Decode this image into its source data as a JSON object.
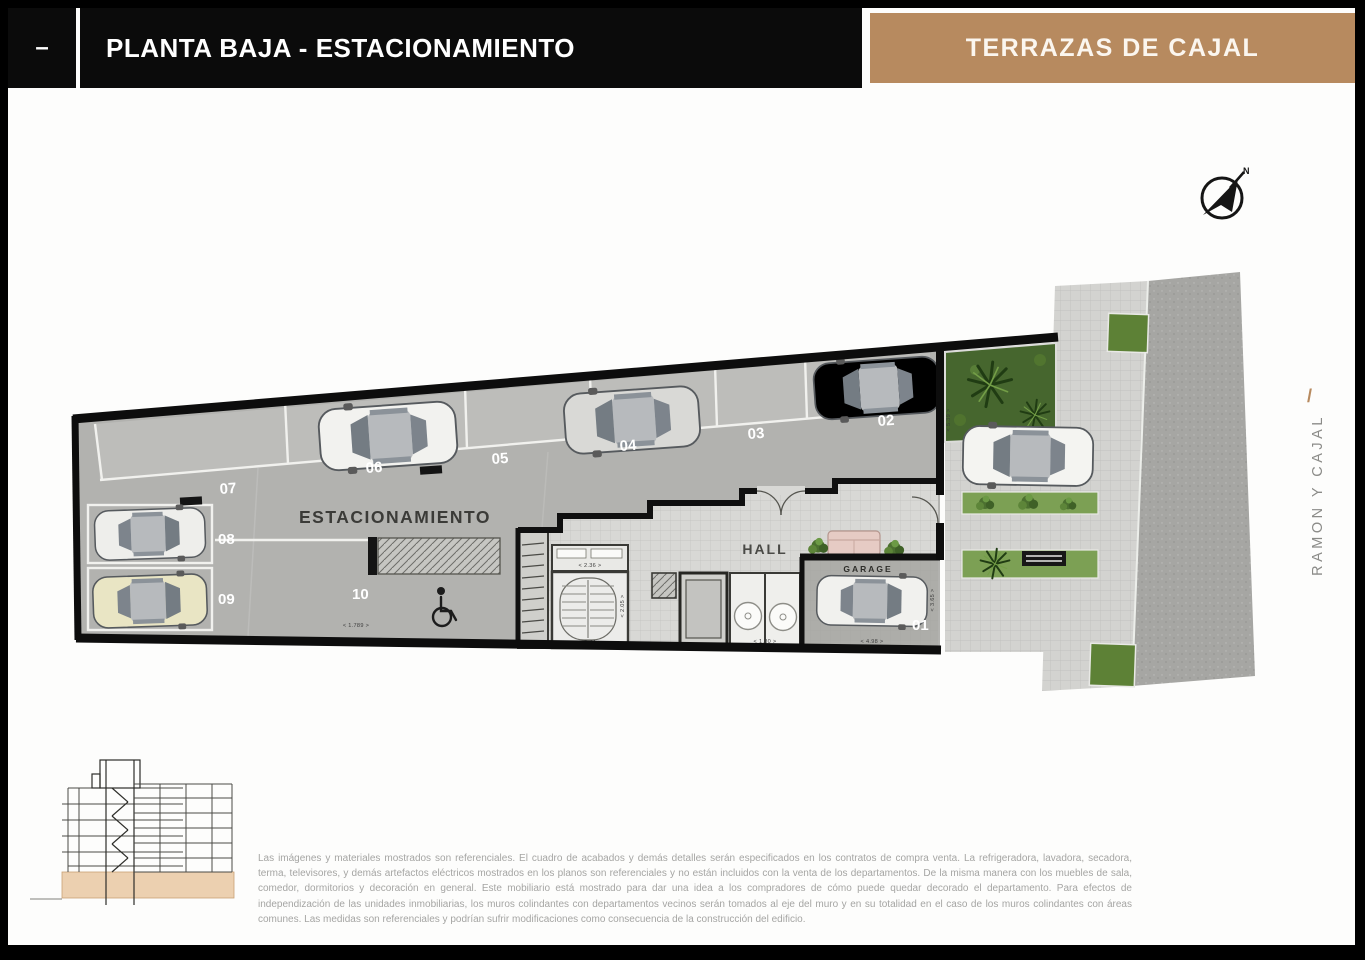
{
  "header": {
    "collapse_dash": "–",
    "title": "PLANTA BAJA - ESTACIONAMIENTO",
    "project": "TERRAZAS DE CAJAL"
  },
  "compass": {
    "north_label": "N"
  },
  "plan": {
    "area_label": "ESTACIONAMIENTO",
    "hall_label": "HALL",
    "garage_label": "GARAGE",
    "street_name": "RAMON Y CAJAL",
    "street_slash": "/",
    "spaces": [
      "01",
      "02",
      "03",
      "04",
      "05",
      "06",
      "07",
      "08",
      "09",
      "10"
    ],
    "dims": {
      "space10": "< 1.789 >",
      "right_wall": "< 5.39 >",
      "meters": "< 2.36 >",
      "stair_w": "< 2.44 >",
      "stair_d": "< 2.05 >",
      "bath": "< 1.80 >",
      "garage_w": "< 4.98 >",
      "garage_d": "< 3.65 >"
    }
  },
  "disclaimer": "Las imágenes y materiales mostrados son referenciales. El cuadro de acabados y demás detalles serán especificados en los contratos de compra venta. La refrigeradora, lavadora, secadora, terma, televisores, y demás artefactos eléctricos mostrados en los planos son referenciales y no están incluidos con la venta de los departamentos. De la misma manera con los muebles de sala, comedor, dormitorios y decoración en general. Este mobiliario está mostrado para dar una idea a los compradores de cómo puede quedar decorado el departamento. Para efectos de independización de las unidades inmobiliarias, los muros colindantes con departamentos vecinos serán tomados al eje del muro y en su totalidad en el caso de los muros colindantes con áreas comunes. Las medidas son referenciales y podrían sufrir modificaciones como consecuencia de la construcción del edificio.",
  "colors": {
    "accent": "#b78a5f",
    "header_black": "#0b0b0b"
  }
}
